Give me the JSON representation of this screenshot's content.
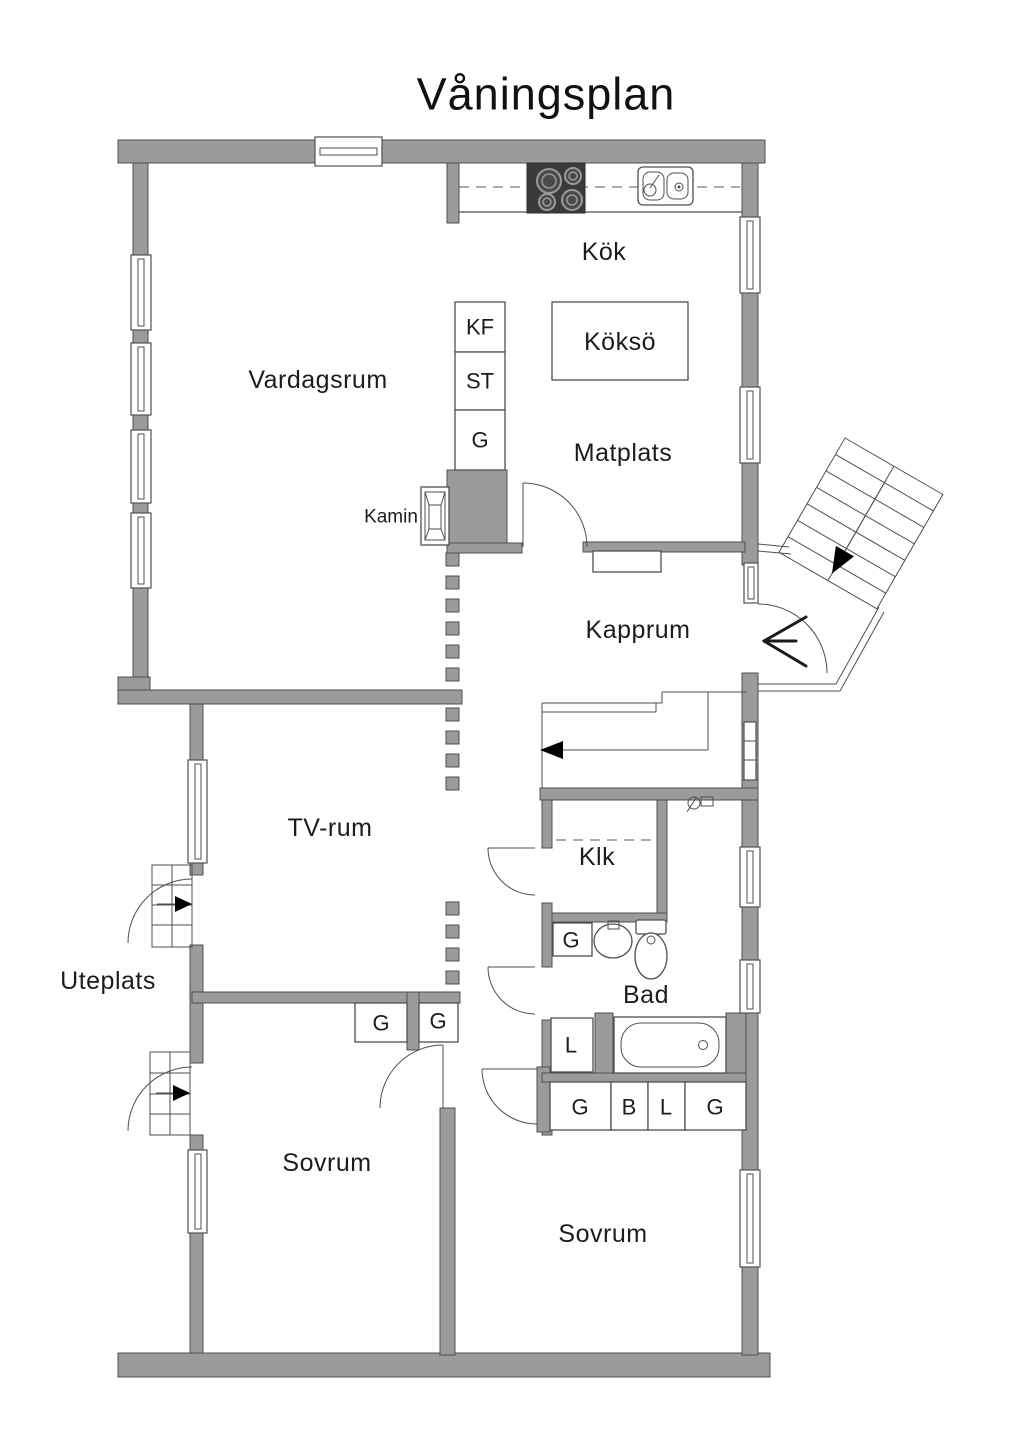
{
  "title": "Våningsplan",
  "rooms": {
    "vardagsrum": "Vardagsrum",
    "kok": "Kök",
    "kokso": "Köksö",
    "matplats": "Matplats",
    "kamin": "Kamin",
    "kapprum": "Kapprum",
    "tv_rum": "TV-rum",
    "klk": "Klk",
    "bad": "Bad",
    "uteplats": "Uteplats",
    "sovrum_1": "Sovrum",
    "sovrum_2": "Sovrum"
  },
  "cabinets": {
    "kf": "KF",
    "st": "ST",
    "g_pantry": "G",
    "g_bad": "G",
    "l_bad": "L",
    "row_g1": "G",
    "row_b": "B",
    "row_l": "L",
    "row_g2": "G",
    "g_sovrum": "G",
    "g_hall": "G"
  },
  "colors": {
    "wall": "#9b9b9b",
    "outline": "#4f4f4f",
    "fixture_dark": "#3a3a3a",
    "background": "#ffffff",
    "text": "#1c1c1c"
  }
}
